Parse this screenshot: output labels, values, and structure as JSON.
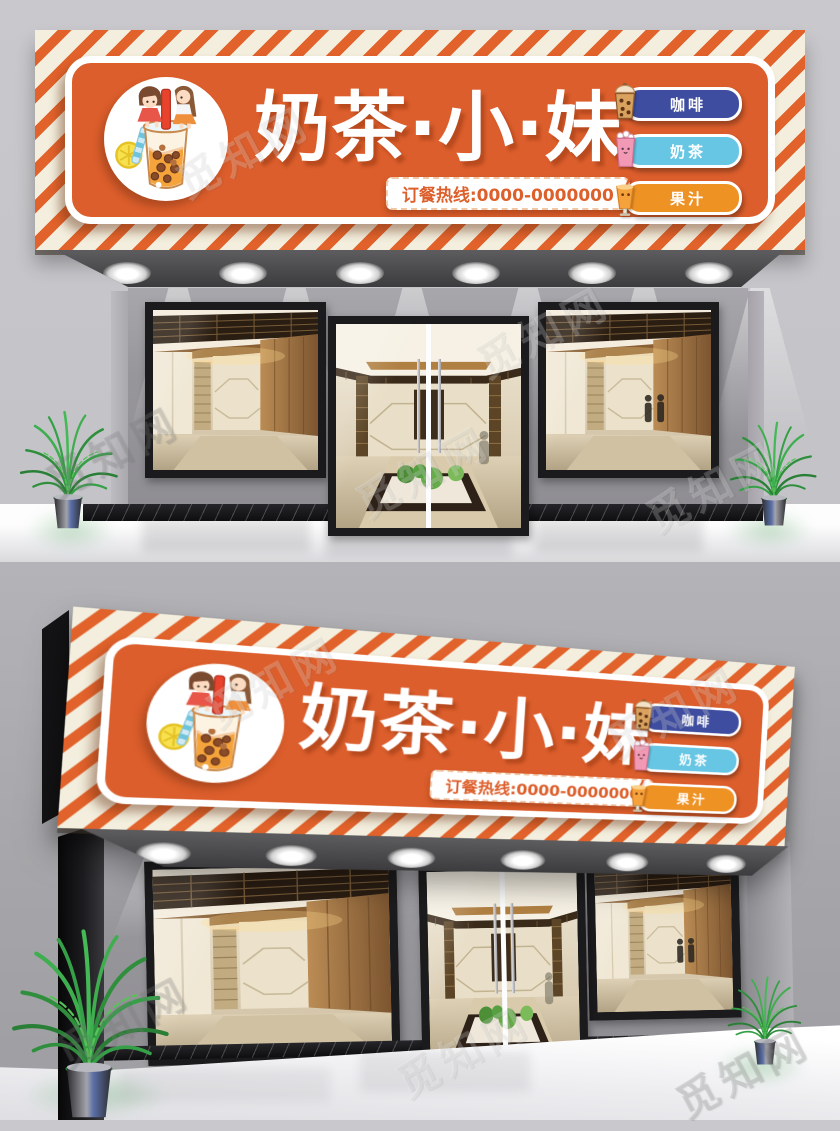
{
  "watermark": {
    "text": "觅知网"
  },
  "signboard": {
    "title": "奶茶·小·妹",
    "hotline": "订餐热线:0000-0000000",
    "colors": {
      "stripe_background": "#f3eedd",
      "stripe": "#e2622b",
      "panel": "#dc5e2c",
      "hotline_text": "#dd5f2b"
    },
    "menu": [
      {
        "label": "咖啡",
        "icon": "coffee-cup-icon",
        "color": "#3f4da0"
      },
      {
        "label": "奶茶",
        "icon": "milktea-cup-icon",
        "color": "#66c6e4"
      },
      {
        "label": "果汁",
        "icon": "juice-glass-icon",
        "color": "#ee9224"
      }
    ]
  }
}
